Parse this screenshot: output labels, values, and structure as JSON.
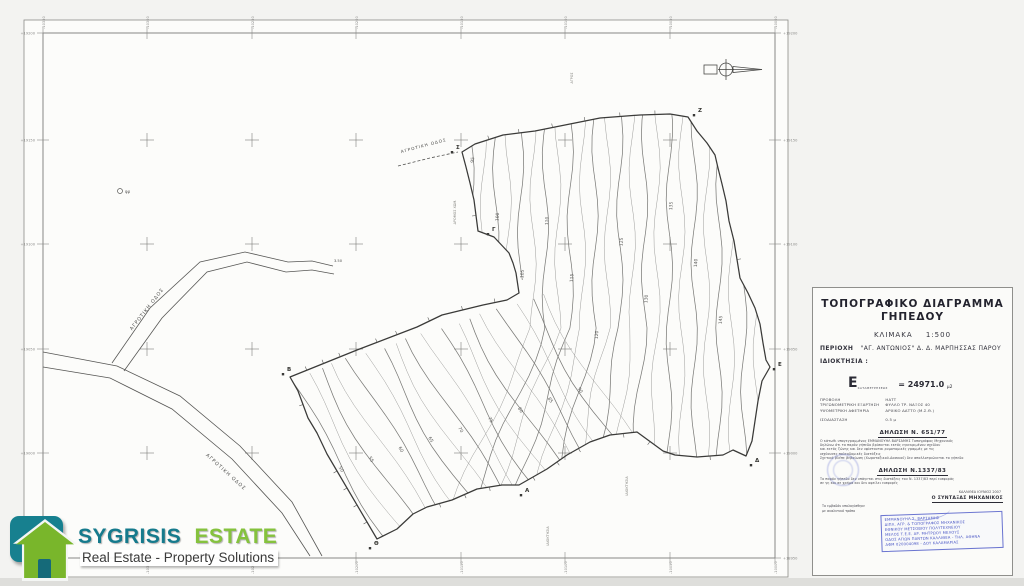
{
  "colors": {
    "teal": "#157a8c",
    "green": "#79b62b",
    "stamp_blue": "#4653c4",
    "line": "#444444",
    "contour": "#9a9a9a",
    "contour_index": "#767676",
    "frame": "#777777"
  },
  "logo": {
    "part1": "SYGRISIS",
    "part2": "ESTATE",
    "tagline": "Real Estate - Property Solutions"
  },
  "title_block": {
    "title1": "ΤΟΠΟΓΡΑΦΙΚΟ  ΔΙΑΓΡΑΜΜΑ",
    "title2": "ΓΗΠΕΔΟΥ",
    "scale_label": "ΚΛΙΜΑΚΑ",
    "scale_value": "1:500",
    "region_label": "ΠΕΡΙΟΧΗ",
    "region_value": "\"ΑΓ. ΑΝΤΩΝΙΟΣ\"  Δ. Δ. ΜΑΡΠΗΣΣΑΣ  ΠΑΡΟΥ",
    "owner_label": "ΙΔΙΟΚΤΗΣΙΑ :",
    "owner_value": "",
    "area_symbol": "Ε",
    "area_sub": "ΚΑΤΑΜΕΤΡΗΣΕΩΣ",
    "area_value": "= 24971.0",
    "area_unit": "μ2",
    "meta": [
      {
        "k": "ΠΡΟΒΟΛΗ",
        "v": "ΗΑΤΤ"
      },
      {
        "k": "ΤΡΙΓΩΝΟΜΕΤΡΙΚΗ ΕΞΑΡΤΗΣΗ",
        "v": "ΦΥΛΛΟ ΤΡ. ΝΑΞΟΣ 40"
      },
      {
        "k": "ΥΨΟΜΕΤΡΙΚΗ ΑΦΕΤΗΡΙΑ",
        "v": "ΑΡΧΙΚΟ ΔΑΤΤΟ (Μ.Σ.Θ.)"
      },
      {
        "k": "ΙΣΟΔΙΑΣΤΑΣΗ",
        "v": "0.5 μ"
      }
    ],
    "decl1_heading": "ΔΗΛΩΣΗ  Ν. 651/77",
    "decl1_lines": [
      "Ο κάτωθι υπογεγραμμένος ΕΜΜΑΝΟΥΗΛ ΒΑΡΣΑΜΗΣ Τοπογράφος Μηχανικός",
      "δηλώνω ότι το παρόν γήπεδο βρίσκεται εκτός εγκεκριμένου σχεδίου",
      "και εκτός ζώνης και δεν υφίστανται ρυμοτομικές γραμμές με τις",
      "ισχύουσες πολεοδομικές διατάξεις",
      "Σχετικά βλέπε βεβαίωση (Χωροταξικού-Δασικού) δεν απαλλοτριώνεται το γήπεδο"
    ],
    "decl2_heading": "ΔΗΛΩΣΗ  Ν.1337/83",
    "decl2_lines": [
      "Το παρόν γήπεδο δεν υπάγεται στις διατάξεις του Ν. 1337/83 περί εισφοράς",
      "σε γη και σε χρήμα και δεν οφείλει εισφορές"
    ],
    "note_lines": [
      "Το εμβαδόν υπολογίσθηκε",
      "με αναλυτικό τρόπο"
    ],
    "place_date": "ΚΑΛΛΙΘΕΑ ΙΟΥΝΙΟΣ 2007",
    "engineer_heading": "Ο ΣΥΝΤΑΞΑΣ ΜΗΧΑΝΙΚΟΣ",
    "stamp_lines": [
      "ΕΜΜΑΝΟΥΗΛ Σ. ΒΑΡΣΑΜΗΣ",
      "ΔΙΠΛ. ΑΓΡ. & ΤΟΠΟΓΡΑΦΟΣ ΜΗΧΑΝΙΚΟΣ",
      "ΕΘΝΙΚΟΥ ΜΕΤΣΟΒΙΟΥ ΠΟΛΥΤΕΧΝΕΙΟΥ",
      "ΜΕΛΟΣ Τ.Ε.Ε. ΑΡ. ΜΗΤΡΩΟΥ ΜΕΛΟΥΣ",
      "ΟΔΟΣ ΑΓΙΩΝ ΠΑΝΤΩΝ ΚΑΛΛΙΘΕΑ - ΤΗΛ. ΑΘΗΝΑ",
      "ΑΦΜ 020004098 - ΔΟΥ ΚΑΛΑΜΑΡΙΑΣ"
    ]
  },
  "map": {
    "outer_rect": [
      24,
      20,
      764,
      557
    ],
    "frame_rect": [
      43,
      33,
      732,
      525
    ],
    "grid_x": [
      147,
      252,
      356,
      461,
      565,
      670
    ],
    "grid_y": [
      140,
      244,
      349,
      453
    ],
    "tick_x": [
      43,
      147,
      252,
      356,
      461,
      565,
      670,
      775
    ],
    "tick_y": [
      33,
      140,
      244,
      349,
      453,
      558
    ],
    "top_labels": [
      "-10350",
      "-10300",
      "-10250",
      "-10200",
      "-10150",
      "-10100",
      "-10050",
      "-10000"
    ],
    "left_labels": [
      "+19200",
      "+19150",
      "+19100",
      "+19050",
      "+19000",
      "+18950"
    ],
    "parcel_outline": [
      [
        462,
        152
      ],
      [
        475,
        144
      ],
      [
        503,
        135
      ],
      [
        535,
        131
      ],
      [
        570,
        124
      ],
      [
        600,
        118
      ],
      [
        640,
        115
      ],
      [
        670,
        114
      ],
      [
        688,
        117
      ],
      [
        697,
        131
      ],
      [
        707,
        143
      ],
      [
        715,
        155
      ],
      [
        718,
        168
      ],
      [
        722,
        184
      ],
      [
        726,
        201
      ],
      [
        729,
        221
      ],
      [
        734,
        241
      ],
      [
        740,
        278
      ],
      [
        748,
        293
      ],
      [
        755,
        308
      ],
      [
        760,
        324
      ],
      [
        763,
        343
      ],
      [
        766,
        360
      ],
      [
        770,
        367
      ],
      [
        762,
        381
      ],
      [
        758,
        401
      ],
      [
        755,
        421
      ],
      [
        752,
        441
      ],
      [
        746,
        456
      ],
      [
        733,
        450
      ],
      [
        723,
        455
      ],
      [
        697,
        457
      ],
      [
        675,
        455
      ],
      [
        663,
        451
      ],
      [
        637,
        432
      ],
      [
        610,
        435
      ],
      [
        590,
        442
      ],
      [
        567,
        455
      ],
      [
        547,
        469
      ],
      [
        519,
        485
      ],
      [
        502,
        485
      ],
      [
        477,
        489
      ],
      [
        452,
        500
      ],
      [
        427,
        507
      ],
      [
        413,
        514
      ],
      [
        397,
        529
      ],
      [
        377,
        539
      ],
      [
        327,
        454
      ],
      [
        317,
        433
      ],
      [
        308,
        418
      ],
      [
        298,
        391
      ],
      [
        290,
        377
      ],
      [
        357,
        350
      ],
      [
        417,
        327
      ],
      [
        442,
        315
      ],
      [
        483,
        305
      ],
      [
        507,
        300
      ],
      [
        519,
        293
      ],
      [
        516,
        273
      ],
      [
        513,
        263
      ],
      [
        509,
        253
      ],
      [
        494,
        237
      ],
      [
        478,
        231
      ],
      [
        474,
        200
      ],
      [
        470,
        183
      ],
      [
        466,
        167
      ]
    ],
    "roads": {
      "main1": [
        [
          43,
          352
        ],
        [
          117,
          366
        ],
        [
          180,
          396
        ],
        [
          240,
          446
        ],
        [
          292,
          502
        ],
        [
          322,
          556
        ]
      ],
      "main2": [
        [
          43,
          367
        ],
        [
          110,
          378
        ],
        [
          172,
          409
        ],
        [
          232,
          459
        ],
        [
          282,
          513
        ],
        [
          310,
          556
        ]
      ],
      "branch1": [
        [
          112,
          363
        ],
        [
          150,
          308
        ],
        [
          200,
          262
        ],
        [
          245,
          252
        ],
        [
          288,
          262
        ],
        [
          312,
          261
        ],
        [
          333,
          266
        ]
      ],
      "branch2": [
        [
          124,
          371
        ],
        [
          162,
          318
        ],
        [
          207,
          272
        ],
        [
          247,
          262
        ],
        [
          286,
          272
        ],
        [
          312,
          270
        ],
        [
          334,
          274
        ]
      ],
      "top_dashed": [
        [
          398,
          166
        ],
        [
          430,
          158
        ],
        [
          458,
          152
        ]
      ]
    },
    "road_label": "ΑΓΡΟΤΙΚΗ ΟΔΟΣ",
    "road_width_label": "3.50",
    "well_label": "φρ",
    "contour_labels_upper": [
      "95",
      "100",
      "105",
      "110",
      "115",
      "120",
      "125",
      "130",
      "135",
      "140",
      "145"
    ],
    "contour_labels_strip": [
      "50",
      "55",
      "60",
      "65",
      "70",
      "75",
      "80",
      "85",
      "90"
    ],
    "vertex_labels": [
      {
        "x": 452,
        "y": 149,
        "t": "Σ"
      },
      {
        "x": 694,
        "y": 112,
        "t": "Ζ"
      },
      {
        "x": 774,
        "y": 366,
        "t": "Ε"
      },
      {
        "x": 751,
        "y": 462,
        "t": "Δ"
      },
      {
        "x": 521,
        "y": 492,
        "t": "Α"
      },
      {
        "x": 370,
        "y": 545,
        "t": "Θ"
      },
      {
        "x": 283,
        "y": 371,
        "t": "Β"
      },
      {
        "x": 488,
        "y": 231,
        "t": "Γ"
      }
    ],
    "misc_labels": [
      {
        "x": 456,
        "y": 212,
        "t": "ΔΡΟΜΟΣ ΧΩΜ.",
        "rot": -90
      },
      {
        "x": 549,
        "y": 536,
        "t": "ΙΔΙΟΚΤΗΣΙΑ",
        "rot": -90
      },
      {
        "x": 628,
        "y": 486,
        "t": "ΙΔΙΟΚΤΗΣΙΑ",
        "rot": -90
      },
      {
        "x": 573,
        "y": 78,
        "t": "ΑΓΡΟΣ",
        "rot": -90
      }
    ]
  }
}
